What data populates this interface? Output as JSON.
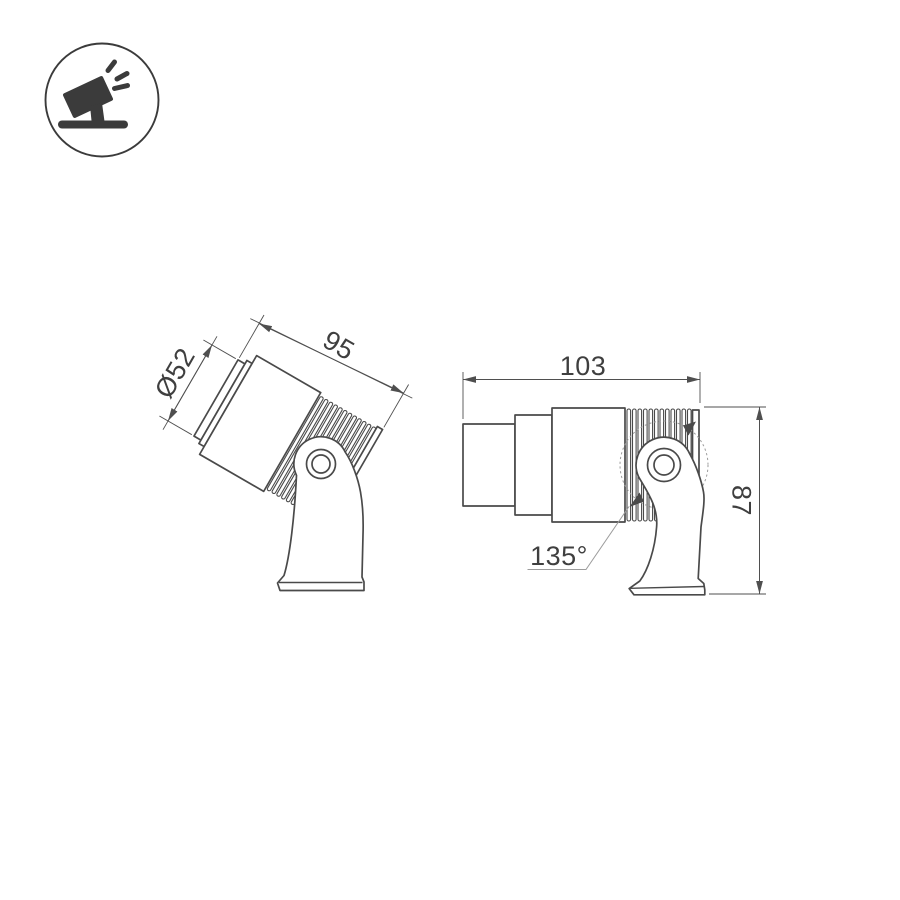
{
  "colors": {
    "line": "#4a4a4a",
    "dimension": "#4f4f4f",
    "text": "#3f3f3f",
    "muted": "#9c9c9c",
    "logo": "#3b3b3b",
    "background": "#ffffff"
  },
  "logo": {
    "icon": "spotlight-on-stand-icon"
  },
  "left_view": {
    "diameter_label": "Ø52",
    "length_label": "95"
  },
  "right_view": {
    "width_label": "103",
    "height_label": "87",
    "tilt_angle_label": "135°"
  }
}
